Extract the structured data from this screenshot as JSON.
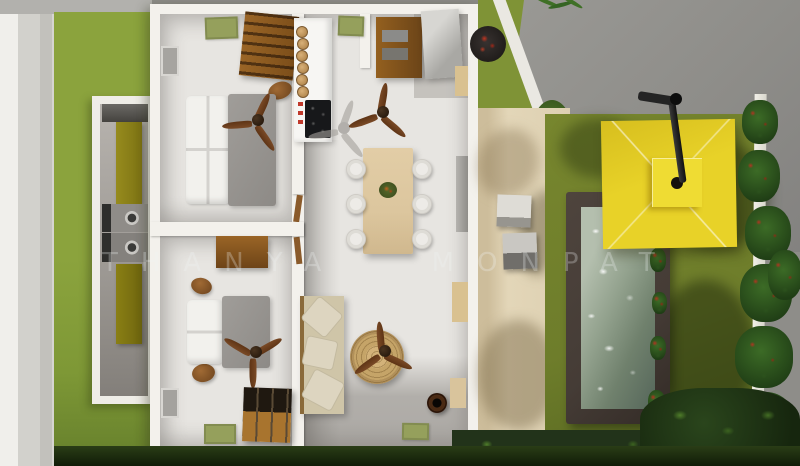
{
  "scene": {
    "type": "3d-architectural-top-view-render",
    "description": "Top-down 3D dollhouse render of a two-bedroom house with open living/dining/kitchen, side laundry annex, paved terrace, swimming pool, yellow cantilever umbrella, lawns, hedges and white fence",
    "watermark": "THANYA MONPAT"
  },
  "palette": {
    "grass-bright": "#8ba33d",
    "grass-olive": "#6e7d2b",
    "wall-white": "#f3f1ec",
    "floor": "#e7e5e1",
    "wood": "#94601f",
    "wood-dark": "#6b4418",
    "mat-green": "#95a05c",
    "table-tan": "#dcc69e",
    "blanket-gray": "#a09d99",
    "pillow-white": "#f2f1ed",
    "rattan": "#c9a86c",
    "sofa-beige": "#cfc5a8",
    "path-beige": "#ddd0b2",
    "pool-frame": "#453c36",
    "pool-water": "#8d9c8b",
    "umbrella-yellow": "#e8d228",
    "concrete-gray": "#8e8d89",
    "olive-door": "#968b1d",
    "foliage-dark": "#22331a",
    "flower-red": "#b03420",
    "fan-wood": "#7a4a26",
    "cooktop-black": "#17181a",
    "watermark-color": "rgba(240,244,246,0.28)"
  },
  "inventory": {
    "house_rooms": [
      {
        "name": "bedroom-top-left",
        "items": [
          "double-bed",
          "ceiling-fan",
          "bookshelf",
          "green-rug",
          "window",
          "pouf"
        ]
      },
      {
        "name": "bedroom-bottom-left",
        "items": [
          "double-bed",
          "ceiling-fan",
          "desk",
          "dresser",
          "green-mat",
          "window",
          "poufs"
        ]
      },
      {
        "name": "living-dining-kitchen",
        "items": [
          "kitchen-counter-cooktop",
          "dining-table",
          "six-chairs",
          "wardrobe",
          "fridge-counter",
          "sofa",
          "round-rattan-rug",
          "ceiling-fans",
          "green-mats",
          "planter-pot"
        ]
      }
    ],
    "exterior": [
      "left-concrete-path",
      "left-lawn",
      "laundry-annex-with-washing-machines",
      "paved-terrace",
      "two-outdoor-stools",
      "swimming-pool",
      "yellow-cantilever-umbrella",
      "right-lawn",
      "flowering-hedge",
      "white-fence",
      "neighbor-concrete-area",
      "bottom-foliage-hedge"
    ]
  }
}
